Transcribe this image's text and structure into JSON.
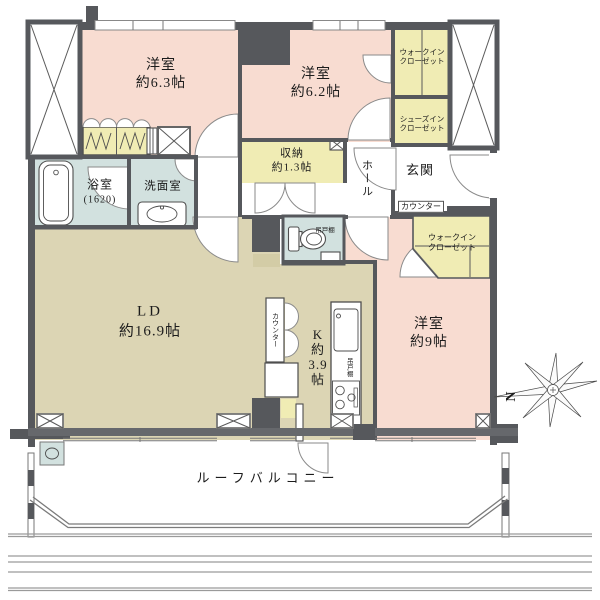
{
  "floorplan": {
    "rooms": {
      "bedroom_top_left": {
        "name": "洋室",
        "size": "約6.3帖"
      },
      "bedroom_top_middle": {
        "name": "洋室",
        "size": "約6.2帖"
      },
      "bedroom_right": {
        "name": "洋室",
        "size": "約9帖"
      },
      "living_dining": {
        "name": "LD",
        "size": "約16.9帖"
      },
      "kitchen": {
        "name": "K",
        "size_prefix": "約",
        "size_value": "3.9",
        "size_unit": "帖"
      },
      "storage": {
        "name": "収納",
        "size": "約1.3帖"
      },
      "bathroom": {
        "name": "浴室",
        "size": "(1620)"
      },
      "washroom": {
        "name": "洗面室"
      },
      "hall": {
        "name": "ホール"
      },
      "entrance": {
        "name": "玄関"
      }
    },
    "closets": {
      "walk_in_closet_north": {
        "line1": "ウォークイン",
        "line2": "クローゼット"
      },
      "shoes_in_closet": {
        "line1": "シューズイン",
        "line2": "クローゼット"
      },
      "walk_in_closet_south": {
        "line1": "ウォークイン",
        "line2": "クローゼット"
      }
    },
    "fixtures": {
      "entrance_counter": "カウンター",
      "kitchen_counter": "カウンター",
      "kitchen_hanging_cupboard": "吊戸棚",
      "toilet_hanging_cupboard": "吊戸棚"
    },
    "balcony": {
      "label": "ルーフバルコニー"
    },
    "compass": {
      "north_label": "N"
    },
    "colors": {
      "room-pink": "#f8dcd1",
      "closet-yellow": "#f0ecb4",
      "wet-blue": "#d2e1df",
      "floor-beige": "#dcd5b4",
      "wall-dark": "#56585c",
      "wall-mid": "#66686c",
      "text-dark": "#1c1c1c"
    }
  }
}
